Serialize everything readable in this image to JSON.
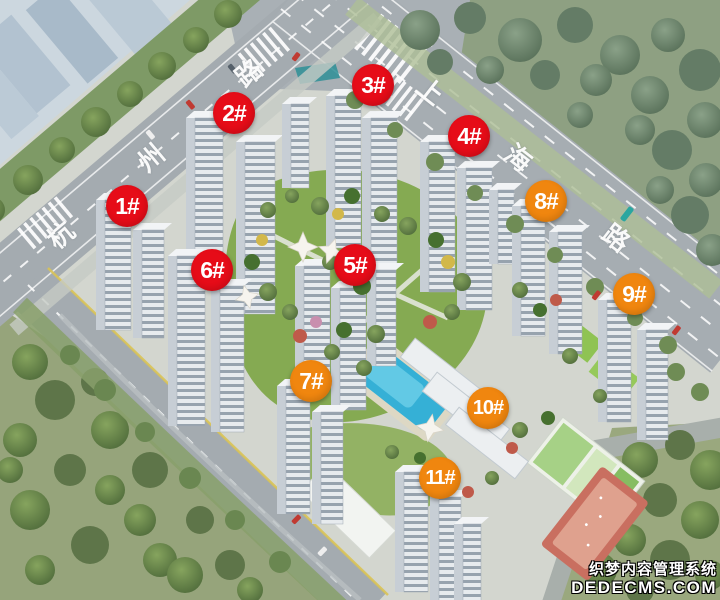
{
  "scene": {
    "type": "aerial-rendering-of-residential-complex",
    "colors": {
      "marker_red": "#e60c18",
      "marker_orange": "#f0860f",
      "road": "#a4abb0",
      "forest": "#94a37c",
      "lawn": "#86ab54",
      "pool": "#35b0d6"
    }
  },
  "markers": [
    {
      "label": "1#",
      "x": 127,
      "y": 206,
      "color": "red"
    },
    {
      "label": "2#",
      "x": 234,
      "y": 113,
      "color": "red"
    },
    {
      "label": "3#",
      "x": 373,
      "y": 85,
      "color": "red"
    },
    {
      "label": "4#",
      "x": 469,
      "y": 136,
      "color": "red"
    },
    {
      "label": "5#",
      "x": 355,
      "y": 265,
      "color": "red"
    },
    {
      "label": "6#",
      "x": 212,
      "y": 270,
      "color": "red"
    },
    {
      "label": "7#",
      "x": 311,
      "y": 381,
      "color": "orange"
    },
    {
      "label": "8#",
      "x": 546,
      "y": 201,
      "color": "orange"
    },
    {
      "label": "9#",
      "x": 634,
      "y": 294,
      "color": "orange"
    },
    {
      "label": "10#",
      "x": 488,
      "y": 408,
      "color": "orange"
    },
    {
      "label": "11#",
      "x": 440,
      "y": 478,
      "color": "orange"
    }
  ],
  "streets": [
    {
      "name": "杭州路",
      "rotation": -40,
      "chars": [
        {
          "t": "杭",
          "x": 60,
          "y": 234
        },
        {
          "t": "州",
          "x": 150,
          "y": 157
        },
        {
          "t": "路",
          "x": 248,
          "y": 72
        }
      ]
    },
    {
      "name": "上海路",
      "rotation": 38,
      "chars": [
        {
          "t": "上",
          "x": 431,
          "y": 90
        },
        {
          "t": "海",
          "x": 519,
          "y": 157
        },
        {
          "t": "路",
          "x": 617,
          "y": 237
        }
      ]
    }
  ],
  "watermark": {
    "line1": "织梦内容管理系统",
    "line2": "DEDECMS.COM"
  }
}
